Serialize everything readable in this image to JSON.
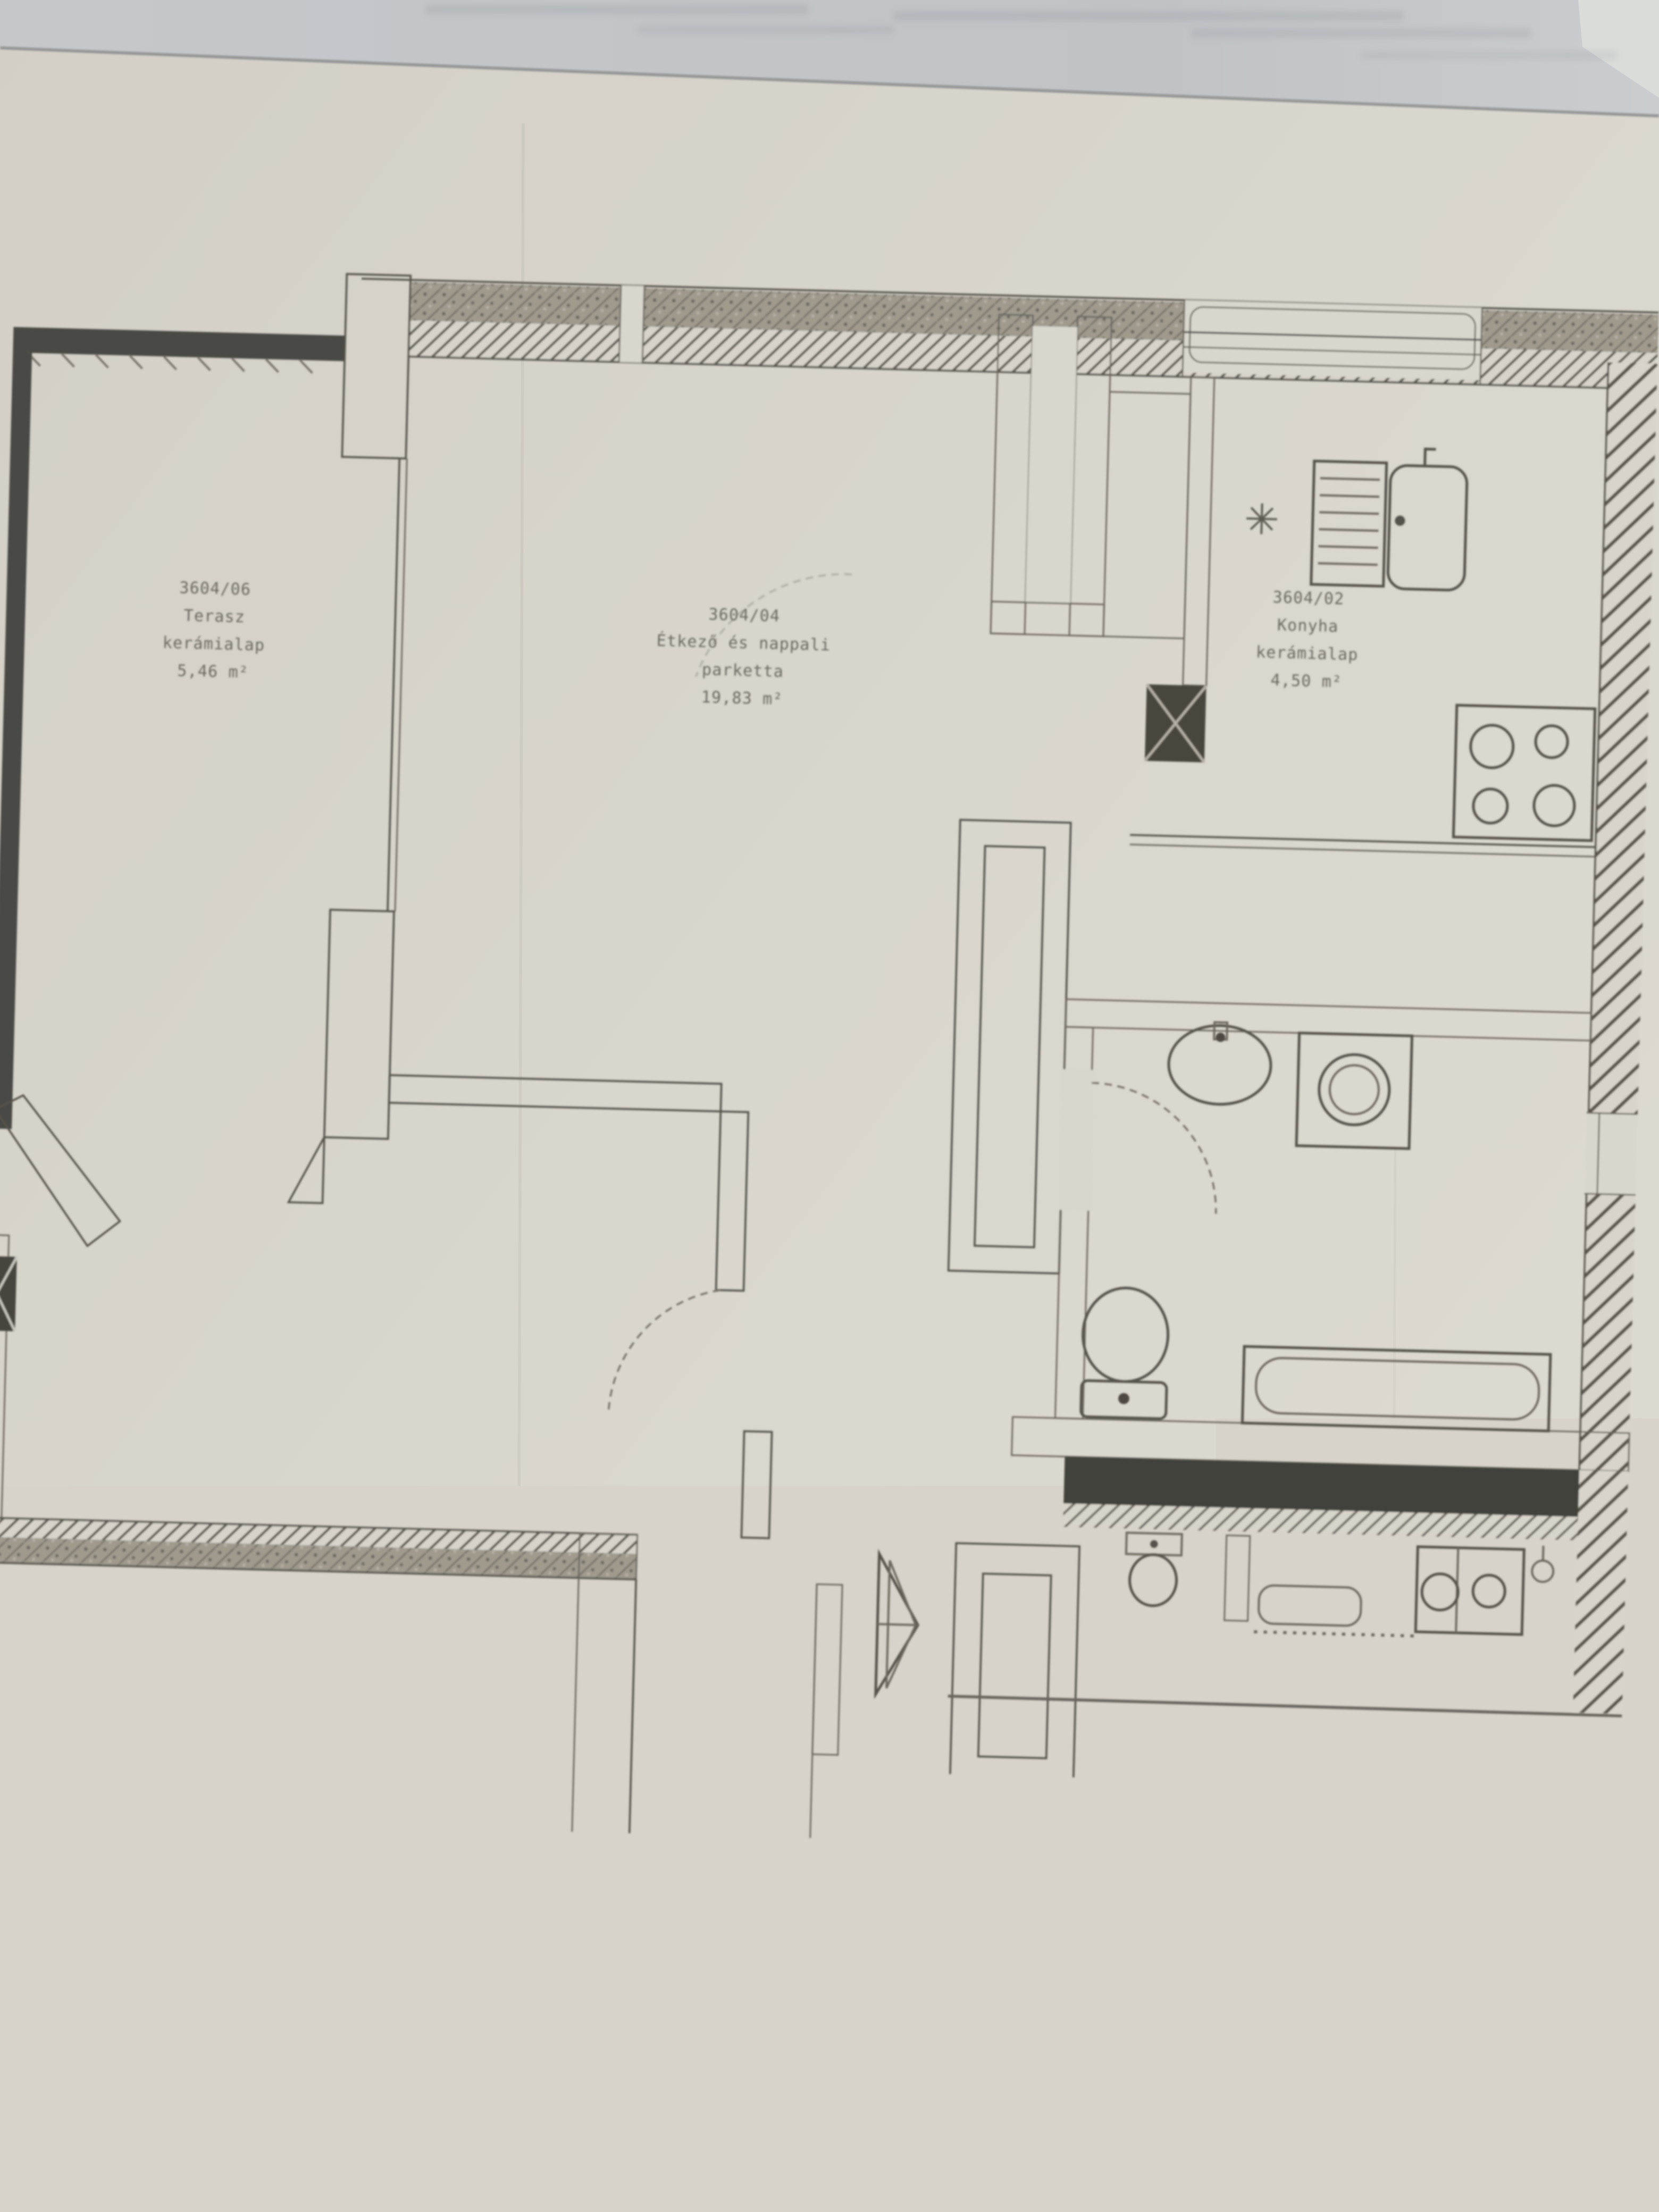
{
  "document": {
    "type": "scanned floor plan photo",
    "language": "Hungarian"
  },
  "rooms": [
    {
      "id": "terasz",
      "parcel": "3604/06",
      "name": "Terasz",
      "floor": "kerámialap",
      "area": "5,46 m²"
    },
    {
      "id": "etkezo",
      "parcel": "3604/04",
      "name": "Étkező és nappali",
      "floor": "parketta",
      "area": "19,83 m²"
    },
    {
      "id": "konyha",
      "parcel": "3604/02",
      "name": "Konyha",
      "floor": "kerámialap",
      "area": "4,50 m²"
    },
    {
      "id": "szoba",
      "parcel": "3604/05",
      "name": "Szoba",
      "floor": "parketta",
      "area": "8,33 m²"
    },
    {
      "id": "eloter",
      "parcel": "3604/01",
      "name": "Előtér",
      "floor": "kerámialap",
      "area": "5,79 m²"
    },
    {
      "id": "furdo",
      "parcel": "3604/03",
      "name": "Fürdő",
      "floor": "kerámialap",
      "area": "3,88 m²"
    }
  ],
  "annotations": {
    "shaft_room": "KSZ",
    "column_size": "25/25"
  },
  "symbols": {
    "vent_fan": "✳"
  },
  "colors": {
    "paper": "#dedbd2",
    "background_top": "#c6cacd",
    "wall_poche": "#a29c8f",
    "wall_dark": "#3f423b",
    "line": "#57534b",
    "text": "#5f5b52"
  }
}
